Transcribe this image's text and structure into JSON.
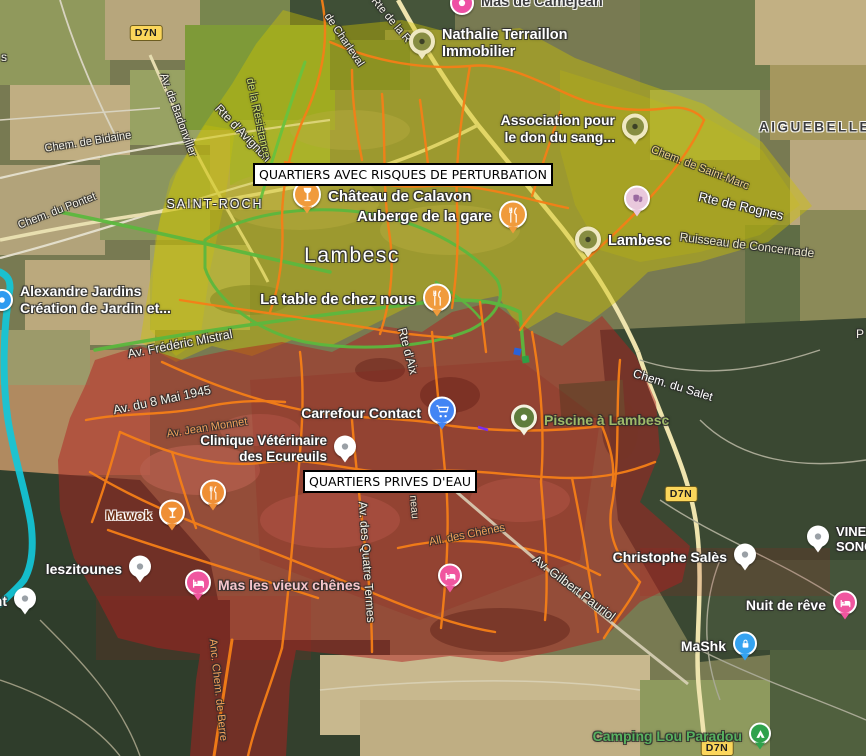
{
  "colors": {
    "yellow_zone": "#cfc400",
    "red_zone": "#b01f1f",
    "cyan_route": "#12c7d9",
    "orange_route": "#f57f17",
    "green_route": "#5cb83e",
    "badge_bg": "#fbd65b"
  },
  "map": {
    "zone_labels": [
      {
        "text": "QUARTIERS AVEC RISQUES DE PERTURBATION",
        "x": 253,
        "y": 163
      },
      {
        "text": "QUARTIERS PRIVES D'EAU",
        "x": 303,
        "y": 470
      }
    ],
    "route_badges": [
      {
        "label": "D7N",
        "x": 146,
        "y": 33
      },
      {
        "label": "D7N",
        "x": 681,
        "y": 494
      },
      {
        "label": "D7N",
        "x": 717,
        "y": 748
      }
    ],
    "road_labels": [
      {
        "text": "Chem. de Bidaine",
        "x": 88,
        "y": 142,
        "rot": -9,
        "size": 11,
        "color": "#f4f2e8",
        "halo": "dark"
      },
      {
        "text": "Chem. du Pontet",
        "x": 57,
        "y": 211,
        "rot": -21,
        "size": 11,
        "color": "#f4f2e8",
        "halo": "dark"
      },
      {
        "text": "Av. de Badonviller",
        "x": 178,
        "y": 115,
        "rot": 70,
        "size": 11,
        "color": "#f4f2e8",
        "halo": "dark"
      },
      {
        "text": "Rte d'Avignon",
        "x": 243,
        "y": 133,
        "rot": 46,
        "size": 12,
        "color": "#f4f2e8",
        "halo": "dark"
      },
      {
        "text": "SAINT-ROCH",
        "x": 215,
        "y": 204,
        "rot": 0,
        "size": 12.5,
        "color": "#ffffff",
        "ls": 2,
        "weight": 500,
        "halo": "dark"
      },
      {
        "text": "de Charleval",
        "x": 344,
        "y": 40,
        "rot": 56,
        "size": 11,
        "color": "#f4f2e8",
        "halo": "dark"
      },
      {
        "text": "Rte de la R",
        "x": 391,
        "y": 20,
        "rot": 50,
        "size": 11,
        "color": "#f4f2e8",
        "halo": "dark"
      },
      {
        "text": "de la Résistance",
        "x": 258,
        "y": 118,
        "rot": 78,
        "size": 11,
        "color": "#cde06a",
        "halo": "dark"
      },
      {
        "text": "Chem. de Saint-Marc",
        "x": 700,
        "y": 168,
        "rot": 21,
        "size": 11,
        "color": "#ecd28e",
        "halo": "dark"
      },
      {
        "text": "Rte de Rognes",
        "x": 741,
        "y": 206,
        "rot": 13,
        "size": 13,
        "color": "#ffffff",
        "halo": "dark"
      },
      {
        "text": "Ruisseau de Concernade",
        "x": 747,
        "y": 245,
        "rot": 7,
        "size": 12,
        "color": "#eae6cd",
        "halo": "dark"
      },
      {
        "text": "AIGUEBELLE",
        "x": 815,
        "y": 127,
        "rot": 0,
        "size": 13.5,
        "color": "#3b3b3d",
        "ls": 2.5,
        "weight": 600,
        "halo": "light"
      },
      {
        "text": "Lambesc",
        "x": 352,
        "y": 256,
        "rot": 0,
        "size": 21,
        "color": "#ffffff",
        "ls": 1.5,
        "weight": 500,
        "halo": "dark"
      },
      {
        "text": "Av. Frédéric Mistral",
        "x": 180,
        "y": 344,
        "rot": -11,
        "size": 12.5,
        "color": "#f4f2e8",
        "halo": "dark"
      },
      {
        "text": "Av. du 8 Mai 1945",
        "x": 162,
        "y": 400,
        "rot": -12,
        "size": 12.5,
        "color": "#f4f2e8",
        "halo": "dark"
      },
      {
        "text": "Av. Jean Monnet",
        "x": 207,
        "y": 428,
        "rot": -9,
        "size": 11,
        "color": "#f2a25c",
        "halo": "dark"
      },
      {
        "text": "Rte d'Aix",
        "x": 408,
        "y": 351,
        "rot": 75,
        "size": 12,
        "color": "#f4f2e8",
        "halo": "dark"
      },
      {
        "text": "Chem. du Salet",
        "x": 673,
        "y": 385,
        "rot": 17,
        "size": 12,
        "color": "#ffffff",
        "halo": "dark"
      },
      {
        "text": "Av. des Quatre Termes",
        "x": 367,
        "y": 562,
        "rot": 86,
        "size": 12,
        "color": "#f4f2e8",
        "halo": "dark"
      },
      {
        "text": "All. des Chênes",
        "x": 467,
        "y": 535,
        "rot": -11,
        "size": 11,
        "color": "#f2a25c",
        "halo": "dark"
      },
      {
        "text": "Av. Gilbert Pauriol",
        "x": 574,
        "y": 588,
        "rot": 37,
        "size": 12.5,
        "color": "#f4f2e8",
        "halo": "dark"
      },
      {
        "text": "Anc. Chem. de Berre",
        "x": 218,
        "y": 690,
        "rot": 84,
        "size": 11,
        "color": "#f2a25c",
        "halo": "dark"
      },
      {
        "text": "neau",
        "x": 414,
        "y": 507,
        "rot": 85,
        "size": 10.5,
        "color": "#efe2cf",
        "halo": "dark"
      },
      {
        "text": "s",
        "x": 4,
        "y": 57,
        "rot": 0,
        "size": 12,
        "color": "#f4f2e8",
        "halo": "dark"
      },
      {
        "text": "P",
        "x": 860,
        "y": 334,
        "rot": 0,
        "size": 12,
        "color": "#f4f2e8",
        "halo": "dark"
      }
    ],
    "pois": [
      {
        "name": "mas-de-camejean",
        "icon": "dot-white",
        "color": "#ee4fa4",
        "x": 462,
        "y": 3,
        "r": 12,
        "tail": false,
        "label": {
          "lines": [
            "Mas de Camejean"
          ],
          "side": "right",
          "color": "#3c3c3c",
          "size": 14.5,
          "halo": "light"
        }
      },
      {
        "name": "nathalie-terraillon-immobilier",
        "icon": "green-poi",
        "color": "#878d42",
        "x": 422,
        "y": 44,
        "r": 13,
        "tail": true,
        "label": {
          "lines": [
            "Nathalie Terraillon",
            "Immobilier"
          ],
          "side": "right",
          "color": "#ffffff",
          "size": 14.5,
          "halo": "dark"
        }
      },
      {
        "name": "association-don-du-sang",
        "icon": "green-poi",
        "color": "#878d42",
        "x": 635,
        "y": 129,
        "r": 13,
        "tail": true,
        "label": {
          "lines": [
            "Association pour",
            "le don du sang..."
          ],
          "side": "left",
          "color": "#ffffff",
          "size": 14,
          "halo": "dark"
        }
      },
      {
        "name": "chateau-de-calavon",
        "icon": "wine",
        "color": "#f09b3c",
        "x": 307,
        "y": 197,
        "r": 14,
        "tail": true,
        "label": {
          "lines": [
            "Château de Calavon"
          ],
          "side": "right",
          "color": "#ffffff",
          "size": 15,
          "halo": "dark"
        }
      },
      {
        "name": "auberge-de-la-gare",
        "icon": "restaurant",
        "color": "#f09b3c",
        "x": 513,
        "y": 217,
        "r": 14,
        "tail": true,
        "label": {
          "lines": [
            "Auberge de la gare"
          ],
          "side": "left",
          "color": "#ffffff",
          "size": 15,
          "halo": "dark"
        }
      },
      {
        "name": "museum-theatre-poi",
        "icon": "masks",
        "color": "#e9c8dc",
        "x": 637,
        "y": 201,
        "r": 13,
        "tail": true,
        "label": null
      },
      {
        "name": "lambesc-poi",
        "icon": "green-poi",
        "color": "#878d42",
        "x": 588,
        "y": 242,
        "r": 13,
        "tail": true,
        "label": {
          "lines": [
            "Lambesc"
          ],
          "side": "right",
          "color": "#ffffff",
          "size": 14.5,
          "halo": "dark"
        }
      },
      {
        "name": "la-table-de-chez-nous",
        "icon": "restaurant",
        "color": "#f09b3c",
        "x": 437,
        "y": 300,
        "r": 14,
        "tail": true,
        "label": {
          "lines": [
            "La table de chez nous"
          ],
          "side": "left",
          "color": "#ffffff",
          "size": 15,
          "halo": "dark"
        }
      },
      {
        "name": "alexandre-jardins",
        "icon": "dot-white",
        "color": "#2d9bf0",
        "x": 2,
        "y": 300,
        "r": 11,
        "tail": false,
        "label": {
          "lines": [
            "Alexandre Jardins",
            "Création de Jardin et..."
          ],
          "side": "right",
          "color": "#ffffff",
          "size": 14,
          "halo": "dark"
        }
      },
      {
        "name": "carrefour-contact",
        "icon": "cart",
        "color": "#4285f4",
        "x": 442,
        "y": 413,
        "r": 14,
        "tail": true,
        "label": {
          "lines": [
            "Carrefour Contact"
          ],
          "side": "left",
          "color": "#ffffff",
          "size": 14,
          "halo": "dark"
        }
      },
      {
        "name": "clinique-veterinaire-des-ecureuils",
        "icon": "dot-pin",
        "color": "#ffffff",
        "x": 345,
        "y": 449,
        "r": 11,
        "tail": true,
        "label": {
          "lines": [
            "Clinique Vétérinaire",
            "des Ecureuils"
          ],
          "side": "left",
          "color": "#ffffff",
          "size": 13.5,
          "halo": "dark"
        }
      },
      {
        "name": "piscine-a-lambesc",
        "icon": "pool",
        "color": "#5f7d3c",
        "x": 524,
        "y": 420,
        "r": 13,
        "tail": true,
        "label": {
          "lines": [
            "Piscine à Lambesc"
          ],
          "side": "right",
          "color": "#9fb968",
          "size": 14,
          "halo": "dark"
        }
      },
      {
        "name": "restaurant-poi-west",
        "icon": "restaurant",
        "color": "#ef8f35",
        "x": 213,
        "y": 495,
        "r": 13,
        "tail": true,
        "label": null
      },
      {
        "name": "mawok",
        "icon": "cocktail",
        "color": "#ef8f35",
        "x": 172,
        "y": 515,
        "r": 13,
        "tail": true,
        "label": {
          "lines": [
            "Mawok"
          ],
          "side": "left",
          "color": "#6d2f16",
          "size": 14,
          "halo": "light"
        }
      },
      {
        "name": "leszitounes",
        "icon": "dot-pin",
        "color": "#ffffff",
        "x": 140,
        "y": 569,
        "r": 11,
        "tail": true,
        "label": {
          "lines": [
            "leszitounes"
          ],
          "side": "left",
          "color": "#ffffff",
          "size": 14,
          "halo": "dark"
        }
      },
      {
        "name": "mas-les-vieux-chenes",
        "icon": "bed",
        "color": "#f0569f",
        "x": 198,
        "y": 585,
        "r": 13,
        "tail": true,
        "label": {
          "lines": [
            "Mas les vieux chênes"
          ],
          "side": "right",
          "color": "#f6c6cc",
          "size": 14,
          "halo": "dark"
        }
      },
      {
        "name": "lodging-poi-center",
        "icon": "bed",
        "color": "#f0569f",
        "x": 450,
        "y": 578,
        "r": 12,
        "tail": true,
        "label": null
      },
      {
        "name": "christophe-sales",
        "icon": "dot-pin",
        "color": "#ffffff",
        "x": 745,
        "y": 557,
        "r": 11,
        "tail": true,
        "label": {
          "lines": [
            "Christophe Salès"
          ],
          "side": "left",
          "color": "#ffffff",
          "size": 14,
          "halo": "dark"
        }
      },
      {
        "name": "vinet-song",
        "icon": "dot-pin",
        "color": "#ffffff",
        "x": 818,
        "y": 539,
        "r": 11,
        "tail": true,
        "label": {
          "lines": [
            "VINET",
            "SONG..."
          ],
          "side": "right",
          "color": "#ffffff",
          "size": 13,
          "halo": "dark"
        }
      },
      {
        "name": "nuit-de-reve",
        "icon": "bed",
        "color": "#f0569f",
        "x": 845,
        "y": 605,
        "r": 12,
        "tail": true,
        "label": {
          "lines": [
            "Nuit de rêve"
          ],
          "side": "left",
          "color": "#ffffff",
          "size": 14,
          "halo": "dark"
        }
      },
      {
        "name": "mashk",
        "icon": "lock",
        "color": "#35a3f0",
        "x": 745,
        "y": 646,
        "r": 12,
        "tail": true,
        "label": {
          "lines": [
            "MaShk"
          ],
          "side": "left",
          "color": "#ffffff",
          "size": 14,
          "halo": "dark"
        }
      },
      {
        "name": "camping-lou-paradou",
        "icon": "tent",
        "color": "#2fa24c",
        "x": 760,
        "y": 736,
        "r": 11,
        "tail": true,
        "label": {
          "lines": [
            "Camping Lou Paradou"
          ],
          "side": "left",
          "color": "#58b15f",
          "size": 14,
          "halo": "dark"
        }
      },
      {
        "name": "poi-nt-fragment",
        "icon": "dot-pin",
        "color": "#ffffff",
        "x": 25,
        "y": 601,
        "r": 11,
        "tail": true,
        "label": {
          "lines": [
            "nt"
          ],
          "side": "left",
          "color": "#ffffff",
          "size": 14,
          "halo": "dark"
        }
      }
    ]
  }
}
